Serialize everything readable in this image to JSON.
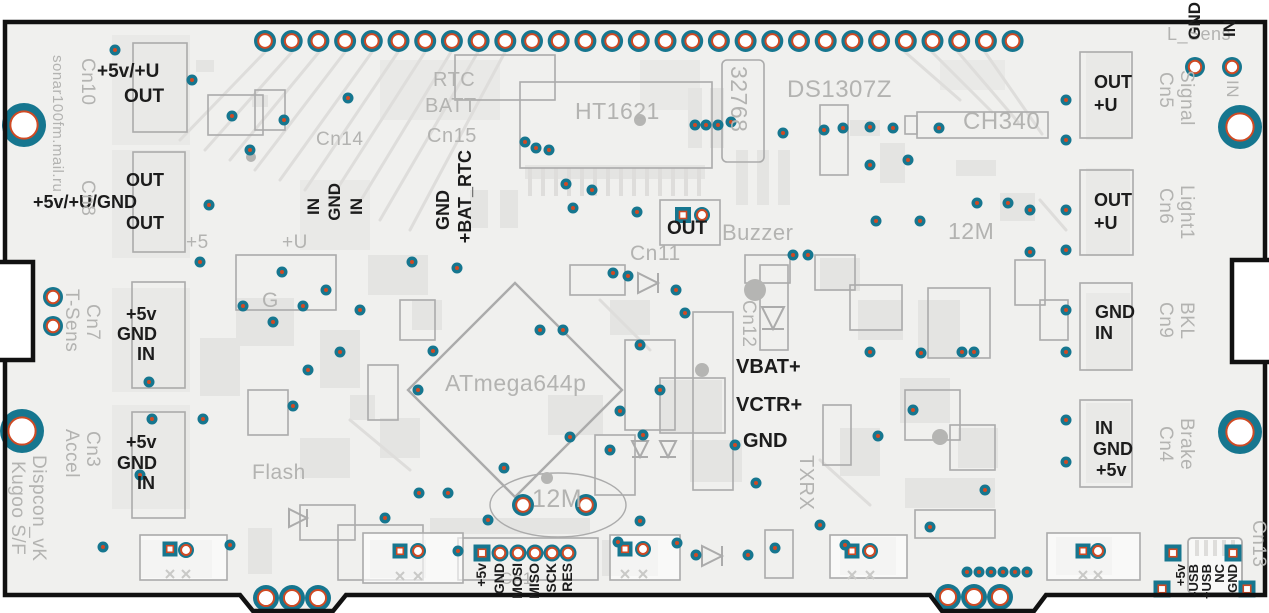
{
  "board": {
    "name": "Dispcon_vK",
    "variant": "Kugoo S/F",
    "author": "sonar100fm.mail.ru"
  },
  "colors": {
    "board_fill": "#f0f0ee",
    "copper_pale": "#e4e4e2",
    "copper_light": "#e9e9e7",
    "silkscreen_gray": "#ababab",
    "trace_gray": "#dedddb",
    "ink_black": "#1c1c1c",
    "pad_teal": "#16768f",
    "pad_ring_orange": "#cf4a24",
    "outline_black": "#111111"
  },
  "ics": {
    "lcd_driver": "HT1621",
    "mcu": "ATmega644p",
    "rtc": "DS1307Z",
    "usb_uart": "CH340",
    "rtc_crystal": "32768",
    "mcu_crystal": "12M",
    "usb_crystal": "12M",
    "flash": "Flash",
    "buzzer": "Buzzer"
  },
  "connectors": {
    "cn1": "Cn1",
    "cn3": "Cn3",
    "cn3_name": "Accel",
    "cn4": "Cn4",
    "cn4_name": "Brake",
    "cn5": "Cn5",
    "cn5_name": "Signal",
    "cn6": "Cn6",
    "cn6_name": "Light1",
    "cn7": "Cn7",
    "cn7_name": "T-Sens",
    "cn8": "Cn8",
    "cn9": "Cn9",
    "cn9_name": "BKL",
    "cn10": "Cn10",
    "cn11": "Cn11",
    "cn12": "Cn12",
    "cn13": "Cn13",
    "cn14": "Cn14",
    "cn15_l1": "RTC",
    "cn15_l2": "BATT",
    "cn15_l3": "Cn15",
    "light_sensor": "L_Sens"
  },
  "pin_labels": {
    "cn10_rail": "+5v/+U",
    "cn10_out": "OUT",
    "cn8_out_top": "OUT",
    "cn8_rail": "+5v/+U/GND",
    "cn8_out_bottom": "OUT",
    "cn7_5v": "+5v",
    "cn7_gnd": "GND",
    "cn7_in": "IN",
    "cn3_5v": "+5v",
    "cn3_gnd": "GND",
    "cn3_in": "IN",
    "cn14_in1": "IN",
    "cn14_gnd": "GND",
    "cn14_in2": "IN",
    "cn15_gnd": "GND",
    "cn15_bat": "+BAT_RTC",
    "buzzer_out": "OUT",
    "vbat": "VBAT+",
    "vctr": "VCTR+",
    "gnd_center": "GND",
    "txrx": "TXRX",
    "g_net": "G",
    "p5_net": "+5",
    "pu_net": "+U",
    "cn5_out": "OUT",
    "cn5_u": "+U",
    "cn6_out": "OUT",
    "cn6_u": "+U",
    "cn9_gnd": "GND",
    "cn9_in": "IN",
    "cn4_in": "IN",
    "cn4_gnd": "GND",
    "cn4_5v": "+5v",
    "ls_gnd": "GND",
    "ls_in": "IN",
    "ls_in_silk": "IN",
    "isp": [
      "+5v",
      "GND",
      "MOSI",
      "MISO",
      "SCK",
      "RES"
    ],
    "usb": [
      "+5v",
      "-USB",
      "+USB",
      "NC",
      "GND"
    ]
  }
}
